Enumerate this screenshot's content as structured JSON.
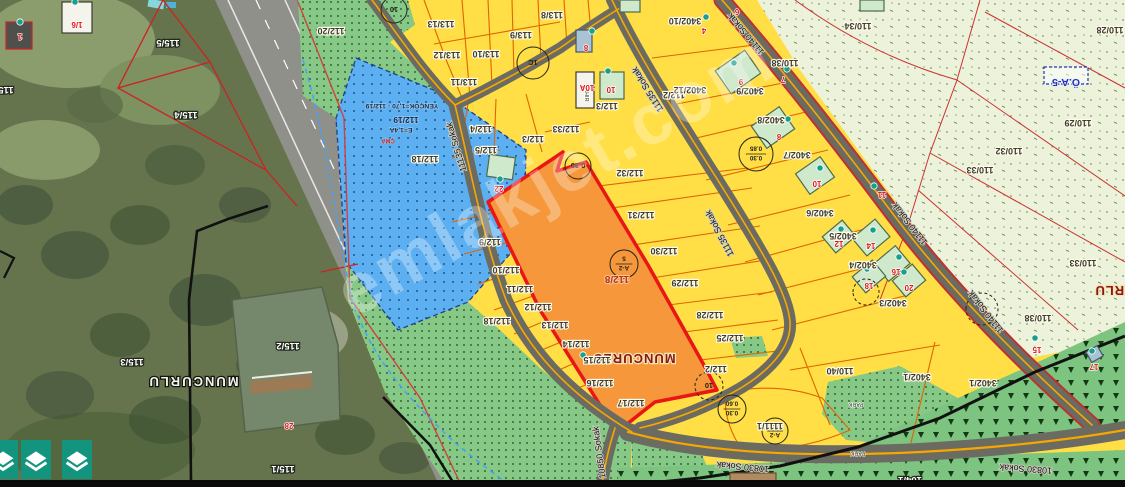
{
  "watermark": "emlakjet.com",
  "colors": {
    "zone_yellow": "#ffdf45",
    "zone_green": "#86c986",
    "zone_blue": "#5cb0f2",
    "zone_pale": "#ecf3da",
    "parcel_highlight": "#f5973a",
    "highlight_border": "#ea1515",
    "parcel_line": "#e06400",
    "road": "#6b6b62",
    "road_center": "#f7a800",
    "button_teal": "#12947f",
    "marker_teal": "#19a08c"
  },
  "map": {
    "labels": [
      {
        "t": "115/5",
        "x": 168,
        "y": 40,
        "c": "s"
      },
      {
        "t": "115/4",
        "x": 186,
        "y": 112,
        "c": "s"
      },
      {
        "t": "115/5",
        "x": 2,
        "y": 87,
        "c": "s"
      },
      {
        "t": "115/3",
        "x": 132,
        "y": 359,
        "c": "s"
      },
      {
        "t": "115/2",
        "x": 288,
        "y": 343,
        "c": "s"
      },
      {
        "t": "115/1",
        "x": 283,
        "y": 466,
        "c": "s"
      },
      {
        "t": "104/1",
        "x": 910,
        "y": 477,
        "c": "s"
      },
      {
        "t": "MUNCURLU",
        "x": 193,
        "y": 377,
        "c": "ps"
      },
      {
        "t": "MUNCURLU",
        "x": 634,
        "y": 354,
        "c": "pp"
      },
      {
        "t": "MUNCURLU",
        "x": 1136,
        "y": 286,
        "c": "pp"
      },
      {
        "t": "YENÇOK=1,70 - 112/19",
        "x": 402,
        "y": 104,
        "c": "b"
      },
      {
        "t": "112/19",
        "x": 406,
        "y": 117,
        "c": "b2"
      },
      {
        "t": "E=1,4A",
        "x": 401,
        "y": 128,
        "c": "b"
      },
      {
        "t": "ÇMA",
        "x": 388,
        "y": 139,
        "c": "tr"
      },
      {
        "t": "112/18",
        "x": 425,
        "y": 156,
        "c": "p"
      },
      {
        "t": "112/20",
        "x": 331,
        "y": 28,
        "c": "p"
      },
      {
        "t": "113/13",
        "x": 441,
        "y": 21,
        "c": "p"
      },
      {
        "t": "113/8",
        "x": 552,
        "y": 12,
        "c": "p"
      },
      {
        "t": "113/9",
        "x": 521,
        "y": 32,
        "c": "p"
      },
      {
        "t": "113/10",
        "x": 486,
        "y": 51,
        "c": "p"
      },
      {
        "t": "113/12",
        "x": 447,
        "y": 52,
        "c": "p"
      },
      {
        "t": "113/11",
        "x": 464,
        "y": 79,
        "c": "p"
      },
      {
        "t": "112/4",
        "x": 481,
        "y": 126,
        "c": "p"
      },
      {
        "t": "112/3",
        "x": 533,
        "y": 136,
        "c": "p"
      },
      {
        "t": "112/33",
        "x": 566,
        "y": 126,
        "c": "p"
      },
      {
        "t": "112/3",
        "x": 607,
        "y": 103,
        "c": "p"
      },
      {
        "t": "112/2",
        "x": 674,
        "y": 92,
        "c": "p"
      },
      {
        "t": "112/5",
        "x": 486,
        "y": 147,
        "c": "p"
      },
      {
        "t": "112/8",
        "x": 617,
        "y": 276,
        "c": "o"
      },
      {
        "t": "112/32",
        "x": 630,
        "y": 170,
        "c": "p"
      },
      {
        "t": "112/31",
        "x": 641,
        "y": 212,
        "c": "p"
      },
      {
        "t": "112/30",
        "x": 664,
        "y": 248,
        "c": "p"
      },
      {
        "t": "112/29",
        "x": 685,
        "y": 280,
        "c": "p"
      },
      {
        "t": "112/28",
        "x": 710,
        "y": 312,
        "c": "p"
      },
      {
        "t": "112/25",
        "x": 730,
        "y": 335,
        "c": "p"
      },
      {
        "t": "112/2",
        "x": 716,
        "y": 366,
        "c": "p"
      },
      {
        "t": "112/9",
        "x": 490,
        "y": 239,
        "c": "p"
      },
      {
        "t": "112/10",
        "x": 506,
        "y": 267,
        "c": "p"
      },
      {
        "t": "112/11",
        "x": 520,
        "y": 286,
        "c": "p"
      },
      {
        "t": "112/12",
        "x": 538,
        "y": 304,
        "c": "p"
      },
      {
        "t": "112/13",
        "x": 555,
        "y": 322,
        "c": "p"
      },
      {
        "t": "112/14",
        "x": 576,
        "y": 341,
        "c": "p"
      },
      {
        "t": "112/15",
        "x": 597,
        "y": 357,
        "c": "p"
      },
      {
        "t": "112/16",
        "x": 600,
        "y": 380,
        "c": "p"
      },
      {
        "t": "112/17",
        "x": 631,
        "y": 400,
        "c": "p"
      },
      {
        "t": "112/18",
        "x": 497,
        "y": 318,
        "c": "p"
      },
      {
        "t": "3402/10",
        "x": 685,
        "y": 18,
        "c": "p"
      },
      {
        "t": "3402/12",
        "x": 690,
        "y": 87,
        "c": "p"
      },
      {
        "t": "3402/9",
        "x": 750,
        "y": 88,
        "c": "p"
      },
      {
        "t": "3402/8",
        "x": 771,
        "y": 117,
        "c": "p"
      },
      {
        "t": "3402/7",
        "x": 797,
        "y": 152,
        "c": "p"
      },
      {
        "t": "3402/6",
        "x": 820,
        "y": 210,
        "c": "p"
      },
      {
        "t": "3402/5",
        "x": 843,
        "y": 233,
        "c": "p"
      },
      {
        "t": "3402/4",
        "x": 863,
        "y": 262,
        "c": "p"
      },
      {
        "t": "3402/3",
        "x": 893,
        "y": 300,
        "c": "p"
      },
      {
        "t": "3402/1",
        "x": 917,
        "y": 374,
        "c": "p"
      },
      {
        "t": "3402/1",
        "x": 983,
        "y": 380,
        "c": "p"
      },
      {
        "t": "110/40",
        "x": 840,
        "y": 368,
        "c": "p"
      },
      {
        "t": "1111/1",
        "x": 770,
        "y": 423,
        "c": "p"
      },
      {
        "t": "110/38",
        "x": 785,
        "y": 60,
        "c": "p"
      },
      {
        "t": "110/34",
        "x": 858,
        "y": 23,
        "c": "p"
      },
      {
        "t": "110/28",
        "x": 1110,
        "y": 27,
        "c": "p"
      },
      {
        "t": "110/29",
        "x": 1078,
        "y": 120,
        "c": "p"
      },
      {
        "t": "110/32",
        "x": 1009,
        "y": 148,
        "c": "p"
      },
      {
        "t": "110/33",
        "x": 980,
        "y": 167,
        "c": "p"
      },
      {
        "t": "110/33",
        "x": 1083,
        "y": 260,
        "c": "p"
      },
      {
        "t": "110/38",
        "x": 1038,
        "y": 315,
        "c": "p"
      },
      {
        "t": "Ö.A-5",
        "x": 1066,
        "y": 79,
        "c": "z"
      },
      {
        "t": "AHIR",
        "x": 585,
        "y": 95,
        "r": 90,
        "c": "t"
      },
      {
        "t": "PARK",
        "x": 856,
        "y": 403,
        "c": "t"
      },
      {
        "t": "PARK",
        "x": 858,
        "y": 452,
        "c": "t"
      },
      {
        "t": "11135 Sokak",
        "x": 459,
        "y": 146,
        "r": 253,
        "c": "st"
      },
      {
        "t": "11135 Sokak",
        "x": 650,
        "y": 88,
        "r": 238,
        "c": "st"
      },
      {
        "t": "11135 Sokak",
        "x": 722,
        "y": 232,
        "r": 242,
        "c": "st"
      },
      {
        "t": "11140 Sokak",
        "x": 748,
        "y": 32,
        "r": 230,
        "c": "st"
      },
      {
        "t": "11140 Sokak",
        "x": 912,
        "y": 222,
        "r": 232,
        "c": "st"
      },
      {
        "t": "11140 Sokak",
        "x": 988,
        "y": 310,
        "r": 232,
        "c": "st"
      },
      {
        "t": "10830 Sokak",
        "x": 743,
        "y": 464,
        "r": 185,
        "c": "st"
      },
      {
        "t": "10830 Sokak",
        "x": 1026,
        "y": 466,
        "r": 184,
        "c": "st"
      },
      {
        "t": "10850 Sokak",
        "x": 602,
        "y": 452,
        "r": 262,
        "c": "st"
      },
      {
        "t": "1/6",
        "x": 77,
        "y": 22,
        "c": "rn"
      },
      {
        "t": "1",
        "x": 20,
        "y": 34,
        "c": "rn"
      },
      {
        "t": "22",
        "x": 499,
        "y": 186,
        "c": "rn"
      },
      {
        "t": "8",
        "x": 586,
        "y": 45,
        "c": "rn"
      },
      {
        "t": "10A",
        "x": 587,
        "y": 85,
        "c": "rn"
      },
      {
        "t": "10",
        "x": 611,
        "y": 87,
        "c": "rn"
      },
      {
        "t": "6",
        "x": 737,
        "y": 9,
        "c": "rn"
      },
      {
        "t": "4",
        "x": 704,
        "y": 28,
        "c": "rn"
      },
      {
        "t": "9",
        "x": 741,
        "y": 79,
        "c": "rn"
      },
      {
        "t": "7",
        "x": 783,
        "y": 77,
        "c": "rn"
      },
      {
        "t": "8",
        "x": 779,
        "y": 134,
        "c": "rn"
      },
      {
        "t": "10",
        "x": 817,
        "y": 181,
        "c": "rn"
      },
      {
        "t": "11",
        "x": 882,
        "y": 192,
        "c": "rn"
      },
      {
        "t": "12",
        "x": 839,
        "y": 241,
        "c": "rn"
      },
      {
        "t": "14",
        "x": 871,
        "y": 243,
        "c": "rn"
      },
      {
        "t": "16",
        "x": 896,
        "y": 269,
        "c": "rn"
      },
      {
        "t": "18",
        "x": 869,
        "y": 283,
        "c": "rn"
      },
      {
        "t": "20",
        "x": 909,
        "y": 285,
        "c": "rn"
      },
      {
        "t": "15",
        "x": 1037,
        "y": 347,
        "c": "rn"
      },
      {
        "t": "17",
        "x": 1094,
        "y": 364,
        "c": "rn"
      },
      {
        "t": "28",
        "x": 289,
        "y": 423,
        "c": "rn"
      }
    ],
    "circles": [
      {
        "x": 533,
        "y": 63,
        "r": 16,
        "l": [
          "1C"
        ]
      },
      {
        "x": 394,
        "y": 10,
        "r": 13,
        "l": [
          "10"
        ]
      },
      {
        "x": 578,
        "y": 166,
        "r": 13,
        "l": [
          "0.30"
        ]
      },
      {
        "x": 756,
        "y": 154,
        "r": 17,
        "l": [
          "0.30",
          "0.85"
        ]
      },
      {
        "x": 624,
        "y": 264,
        "r": 14,
        "l": [
          "A-2",
          "5"
        ]
      },
      {
        "x": 775,
        "y": 431,
        "r": 13,
        "l": [
          "A-2",
          "5"
        ]
      },
      {
        "x": 732,
        "y": 409,
        "r": 14,
        "l": [
          "0.30",
          "0.60"
        ]
      },
      {
        "x": 709,
        "y": 386,
        "r": 14,
        "l": [
          "10"
        ],
        "d": 1
      },
      {
        "x": 982,
        "y": 309,
        "r": 16,
        "l": [],
        "d": 1
      },
      {
        "x": 866,
        "y": 292,
        "r": 13,
        "l": [],
        "d": 1
      }
    ],
    "markers": [
      {
        "x": 75,
        "y": 2
      },
      {
        "x": 20,
        "y": 22
      },
      {
        "x": 592,
        "y": 31
      },
      {
        "x": 608,
        "y": 71
      },
      {
        "x": 500,
        "y": 179
      },
      {
        "x": 583,
        "y": 355
      },
      {
        "x": 706,
        "y": 17
      },
      {
        "x": 734,
        "y": 63
      },
      {
        "x": 787,
        "y": 69
      },
      {
        "x": 788,
        "y": 119
      },
      {
        "x": 820,
        "y": 168
      },
      {
        "x": 874,
        "y": 186
      },
      {
        "x": 841,
        "y": 229
      },
      {
        "x": 873,
        "y": 230
      },
      {
        "x": 899,
        "y": 257
      },
      {
        "x": 867,
        "y": 269
      },
      {
        "x": 904,
        "y": 272
      },
      {
        "x": 1035,
        "y": 338
      },
      {
        "x": 1092,
        "y": 351
      }
    ],
    "buildings": [
      {
        "x": 62,
        "y": 2,
        "w": 30,
        "h": 31,
        "f": "w"
      },
      {
        "x": 6,
        "y": 22,
        "w": 26,
        "h": 27,
        "f": "d"
      },
      {
        "x": 576,
        "y": 30,
        "w": 16,
        "h": 22,
        "f": "b"
      },
      {
        "x": 576,
        "y": 72,
        "w": 18,
        "h": 36,
        "f": "w"
      },
      {
        "x": 600,
        "y": 72,
        "w": 24,
        "h": 27,
        "f": "g"
      },
      {
        "x": 488,
        "y": 156,
        "w": 26,
        "h": 22,
        "r": 8,
        "f": "g"
      },
      {
        "x": 860,
        "y": 0,
        "w": 24,
        "h": 11,
        "f": "g"
      },
      {
        "x": 620,
        "y": 0,
        "w": 20,
        "h": 12,
        "f": "g"
      },
      {
        "x": 720,
        "y": 58,
        "w": 36,
        "h": 28,
        "r": -35,
        "f": "g"
      },
      {
        "x": 756,
        "y": 114,
        "w": 34,
        "h": 27,
        "r": -35,
        "f": "g"
      },
      {
        "x": 800,
        "y": 163,
        "w": 30,
        "h": 25,
        "r": -35,
        "f": "g"
      },
      {
        "x": 826,
        "y": 226,
        "w": 26,
        "h": 21,
        "r": -40,
        "f": "g"
      },
      {
        "x": 856,
        "y": 226,
        "w": 30,
        "h": 23,
        "r": -40,
        "f": "g"
      },
      {
        "x": 878,
        "y": 252,
        "w": 28,
        "h": 23,
        "r": -40,
        "f": "g"
      },
      {
        "x": 856,
        "y": 266,
        "w": 26,
        "h": 21,
        "r": -40,
        "f": "g"
      },
      {
        "x": 896,
        "y": 270,
        "w": 26,
        "h": 21,
        "r": -40,
        "f": "g"
      },
      {
        "x": 1088,
        "y": 348,
        "w": 13,
        "h": 12,
        "r": -30,
        "f": "b"
      },
      {
        "x": 730,
        "y": 473,
        "w": 46,
        "h": 13,
        "f": "t"
      }
    ]
  },
  "controls": {
    "layer_buttons": [
      {
        "name": "layers"
      },
      {
        "name": "layers"
      },
      {
        "name": "layers"
      }
    ]
  }
}
